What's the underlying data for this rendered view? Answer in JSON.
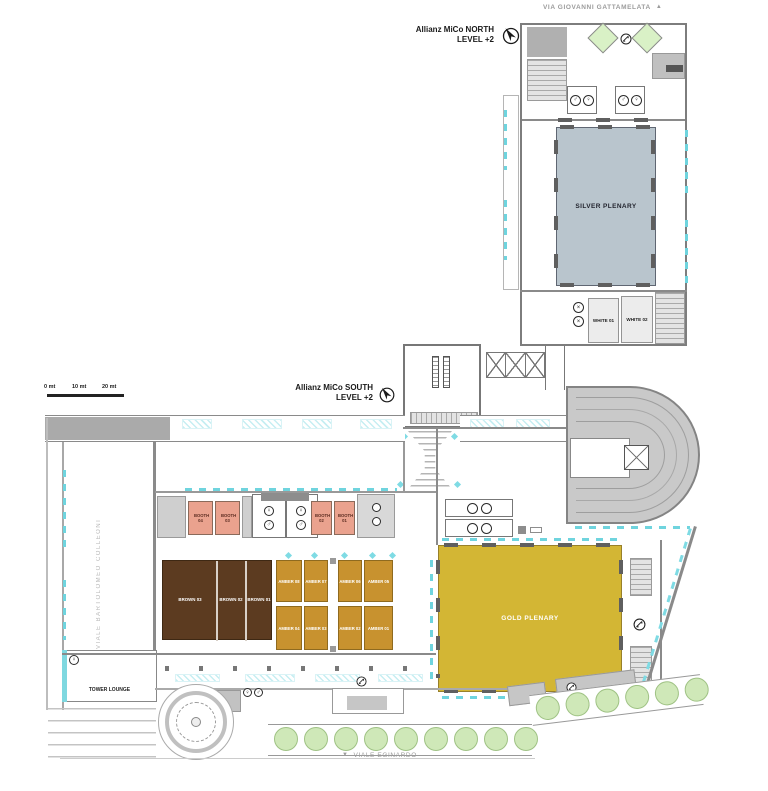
{
  "header": {
    "north_title": "Allianz MiCo NORTH",
    "north_level": "LEVEL +2",
    "south_title": "Allianz MiCo SOUTH",
    "south_level": "LEVEL +2"
  },
  "streets": {
    "top": "VIA GIOVANNI GATTAMELATA",
    "left": "VIALE BARTOLOMEO COLLEONI",
    "bottom": "VIALE EGINARDO"
  },
  "scalebar": {
    "l0": "0 mt",
    "l1": "10 mt",
    "l2": "20 mt"
  },
  "rooms": {
    "silver_plenary": "SILVER PLENARY",
    "gold_plenary": "GOLD PLENARY",
    "tower_lounge": "TOWER LOUNGE",
    "white": [
      "WHITE 01",
      "WHITE 02"
    ],
    "brown": [
      "BROWN 03",
      "BROWN 02",
      "BROWN 01"
    ],
    "booths": [
      "BOOTH 04",
      "BOOTH 03",
      "BOOTH 02",
      "BOOTH 01"
    ],
    "amber": [
      "AMBER 08",
      "AMBER 07",
      "AMBER 06",
      "AMBER 05",
      "AMBER 04",
      "AMBER 03",
      "AMBER 02",
      "AMBER 01"
    ]
  },
  "icons": {
    "north_arrow": "▲",
    "south_arrow": "▼",
    "male": "♂",
    "female": "♀",
    "elevator": "×"
  },
  "colors": {
    "silver": "#b9c5cd",
    "gold": "#d3b634",
    "amber": "#c8922f",
    "brown": "#5c3b20",
    "booth": "#eaa28e",
    "teal": "#6fd4de",
    "tree_green": "#cfe8b8",
    "wall_gray": "#8a8a8a"
  }
}
